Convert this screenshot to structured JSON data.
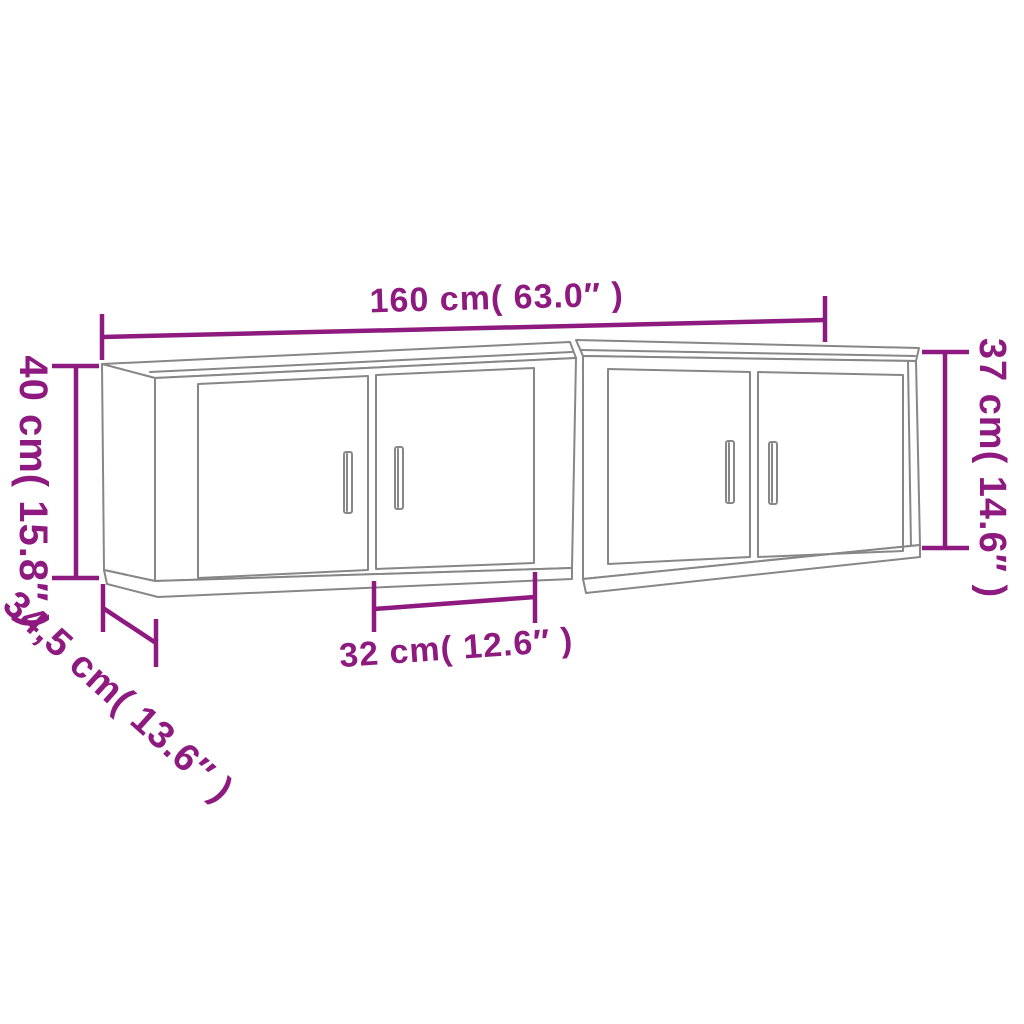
{
  "colors": {
    "dimension": "#8e1a80",
    "outline": "#878787",
    "background": "#ffffff"
  },
  "labels": {
    "width_top": "160 cm( 63.0″ )",
    "height_left": "40 cm( 15.8″ )",
    "height_right": "37 cm( 14.6″ )",
    "depth_diagonal": "34,5 cm( 13.6″ )",
    "door_width_bottom": "32 cm( 12.6″ )"
  },
  "figure": {
    "type": "furniture-dimension-diagram",
    "units": 2,
    "doors_per_unit": 2,
    "handles_per_unit": 2
  }
}
